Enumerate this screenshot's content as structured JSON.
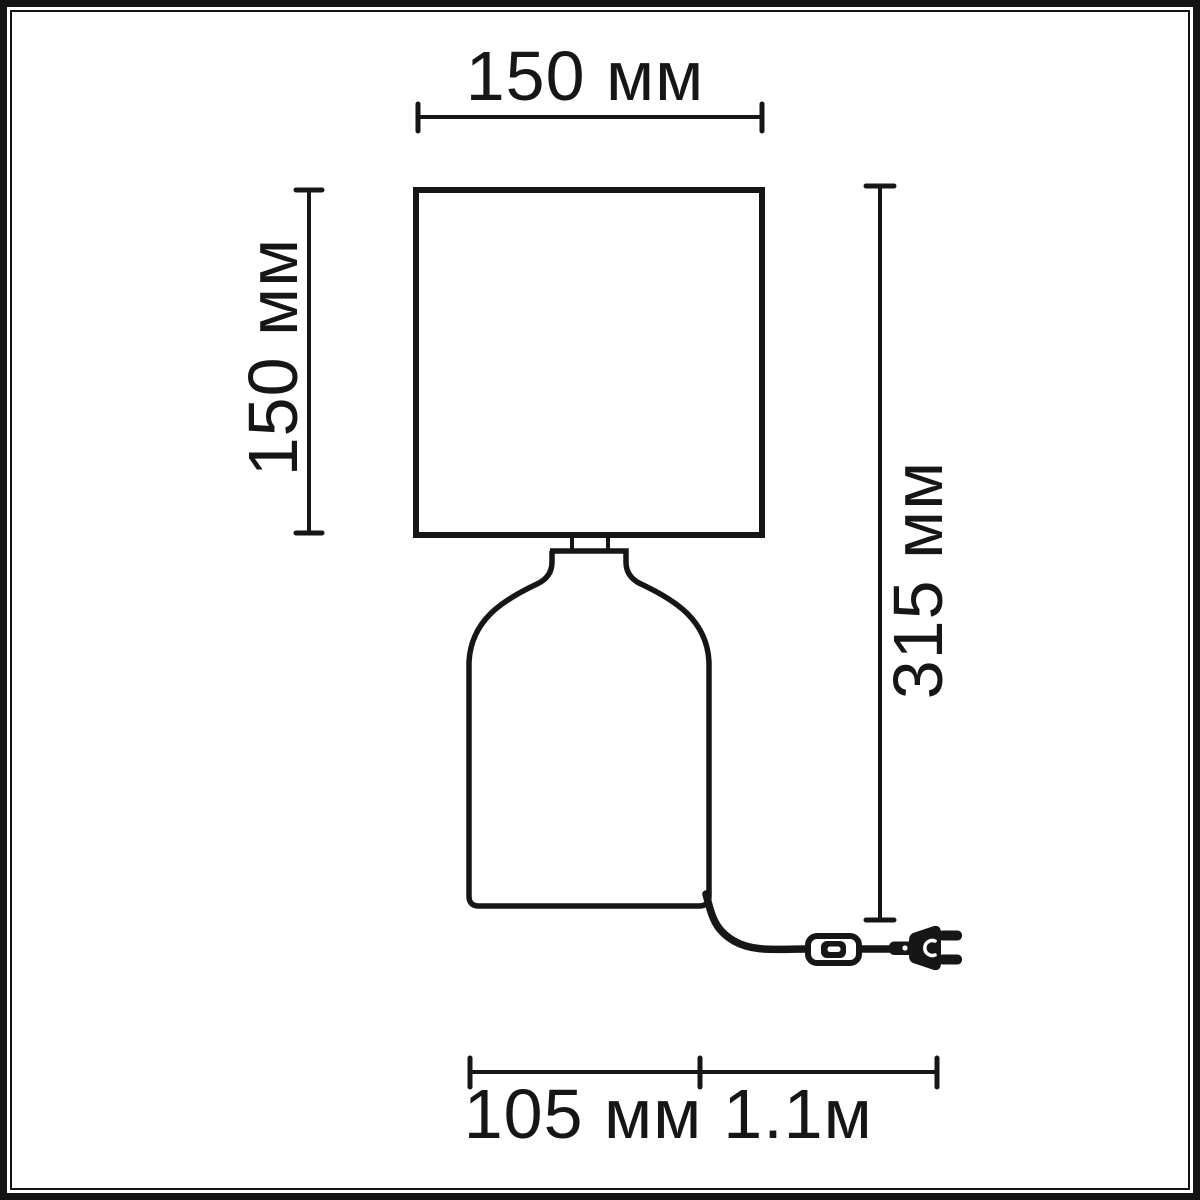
{
  "diagram": {
    "kind": "product dimension drawing",
    "product": "table lamp with shade, dome base, cord switch and plug",
    "labels": {
      "shade_width": "150 мм",
      "shade_height": "150 мм",
      "total_height": "315 мм",
      "base_width": "105 мм",
      "cable_length": "1.1м"
    },
    "colors": {
      "line": "#161616",
      "background": "#ffffff",
      "frame": "#141414"
    },
    "icons": {
      "switch": "inline-cord-switch-icon",
      "plug": "power-plug-icon"
    }
  }
}
